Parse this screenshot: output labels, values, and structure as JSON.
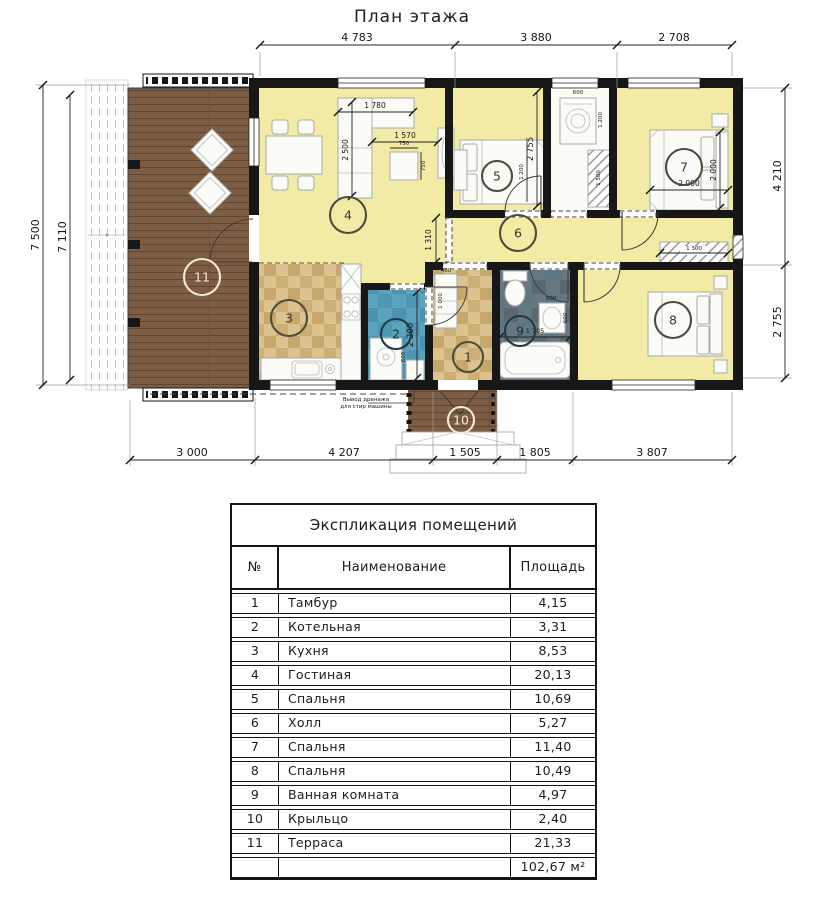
{
  "plan": {
    "title": "План этажа",
    "dims_top": [
      "4 783",
      "3 880",
      "2 708"
    ],
    "dims_left": [
      "7 500",
      "7 110"
    ],
    "dims_right": [
      "4 210",
      "2 755"
    ],
    "dims_bottom": [
      "3 000",
      "4 207",
      "1 505",
      "1 805",
      "3 807"
    ],
    "dims_inner": {
      "sofa_len": "1 780",
      "sofa_depth": "2 500",
      "sofa_to_tv": "1 570",
      "coffee_w": "750",
      "coffee_h": "750",
      "hall_w": "1 310",
      "room5_depth": "2 755",
      "bed5_w": "1 200",
      "washer_w": "600",
      "washer_niche": "1 200",
      "closet_len": "1 500",
      "bed7_w": "2 000",
      "bed7_len": "2 000",
      "wardrobe7_len": "1 300",
      "boiler_depth": "2 200",
      "boiler_w": "600",
      "shelf1_w": "400",
      "shelf1_len": "1 000",
      "bath_len": "1 705",
      "bath_w": "750",
      "sink_w": "500",
      "sink_d": "600"
    },
    "rooms": {
      "r1": "1",
      "r2": "2",
      "r3": "3",
      "r4": "4",
      "r5": "5",
      "r6": "6",
      "r7": "7",
      "r8": "8",
      "r9": "9",
      "r10": "10",
      "r11": "11"
    },
    "note": {
      "line1": "Вывод дренажа",
      "line2": "для стир машины"
    }
  },
  "schedule": {
    "title": "Экспликация помещений",
    "columns": {
      "num": "№",
      "name": "Наименование",
      "area": "Площадь"
    },
    "rows": [
      {
        "num": "1",
        "name": "Тамбур",
        "area": "4,15"
      },
      {
        "num": "2",
        "name": "Котельная",
        "area": "3,31"
      },
      {
        "num": "3",
        "name": "Кухня",
        "area": "8,53"
      },
      {
        "num": "4",
        "name": "Гостиная",
        "area": "20,13"
      },
      {
        "num": "5",
        "name": "Спальня",
        "area": "10,69"
      },
      {
        "num": "6",
        "name": "Холл",
        "area": "5,27"
      },
      {
        "num": "7",
        "name": "Спальня",
        "area": "11,40"
      },
      {
        "num": "8",
        "name": "Спальня",
        "area": "10,49"
      },
      {
        "num": "9",
        "name": "Ванная комната",
        "area": "4,97"
      },
      {
        "num": "10",
        "name": "Крыльцо",
        "area": "2,40"
      },
      {
        "num": "11",
        "name": "Терраса",
        "area": "21,33"
      }
    ],
    "total": "102,67 м²"
  }
}
